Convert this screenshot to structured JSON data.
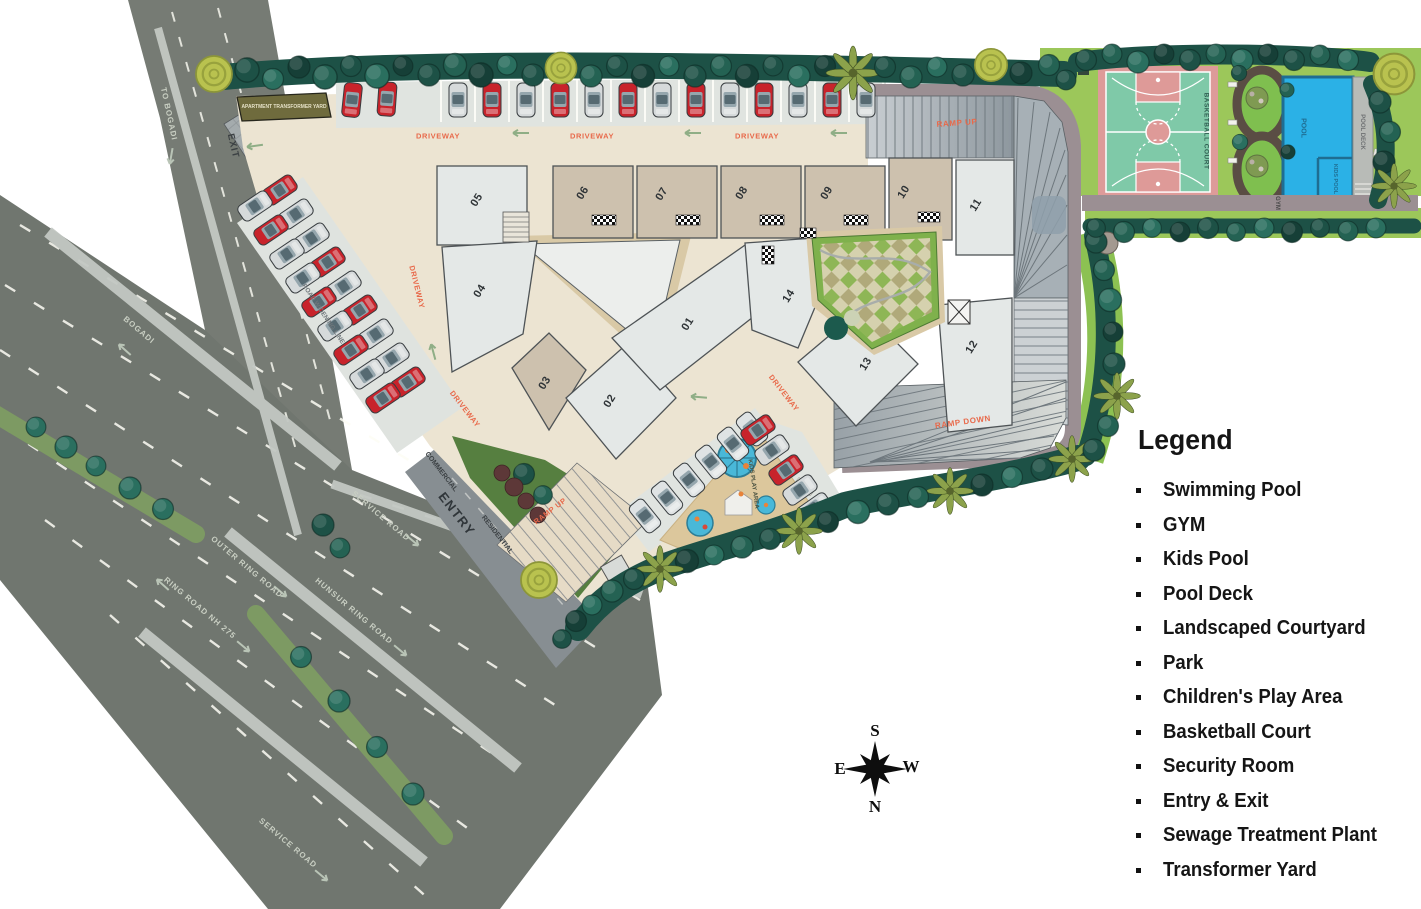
{
  "legend": {
    "title": "Legend",
    "items": [
      "Swimming Pool",
      "GYM",
      "Kids Pool",
      "Pool Deck",
      "Landscaped Courtyard",
      "Park",
      "Children's Play Area",
      "Basketball Court",
      "Security Room",
      "Entry & Exit",
      "Sewage Treatment Plant",
      "Transformer Yard"
    ]
  },
  "compass": {
    "n": "N",
    "s": "S",
    "e": "E",
    "w": "W"
  },
  "roads": {
    "to_bogadi": "TO BOGADI",
    "bogadi": "BOGADI",
    "outer_ring_road": "OUTER RING ROAD",
    "ring_road_nh275": "RING ROAD NH 275",
    "hunsur_ring_road": "HUNSUR RING ROAD",
    "service_road": "SERVICE ROAD"
  },
  "labels": {
    "driveway": "DRIVEWAY",
    "ramp_up": "RAMP UP",
    "ramp_down": "RAMP DOWN",
    "entry": "ENTRY",
    "exit": "EXIT",
    "commercial": "COMMERCIAL",
    "residential": "RESIDENTIAL",
    "road_widening_line": "ROAD WIDENING LINE",
    "apartment_transformer_yard": "APARTMENT TRANSFORMER YARD",
    "kids_play_area": "KIDS PLAY AREA",
    "basketball_court": "BASKETBALL COURT",
    "pool": "POOL",
    "kids_pool": "KIDS POOL",
    "pool_deck": "POOL DECK",
    "gym": "GYM"
  },
  "buildings": [
    "01",
    "02",
    "03",
    "04",
    "05",
    "06",
    "07",
    "08",
    "09",
    "10",
    "11",
    "12",
    "13",
    "14"
  ],
  "colors": {
    "accent_label": "#E8694A",
    "road_asphalt": "#70766F",
    "median_green": "#7D9A63",
    "site_paving": "#ECE4D2",
    "building_light": "#E4E8E7",
    "building_tan": "#CDC1AE",
    "tree_canopy": "#1F5A4E",
    "lawn": "#9CC75A",
    "pool_water": "#2BB1E6",
    "court_green": "#7FC9A8",
    "court_pink": "#DD9B99",
    "perimeter_road": "#9B8F93",
    "car_red": "#C8232B",
    "car_silver": "#D6DADB"
  }
}
